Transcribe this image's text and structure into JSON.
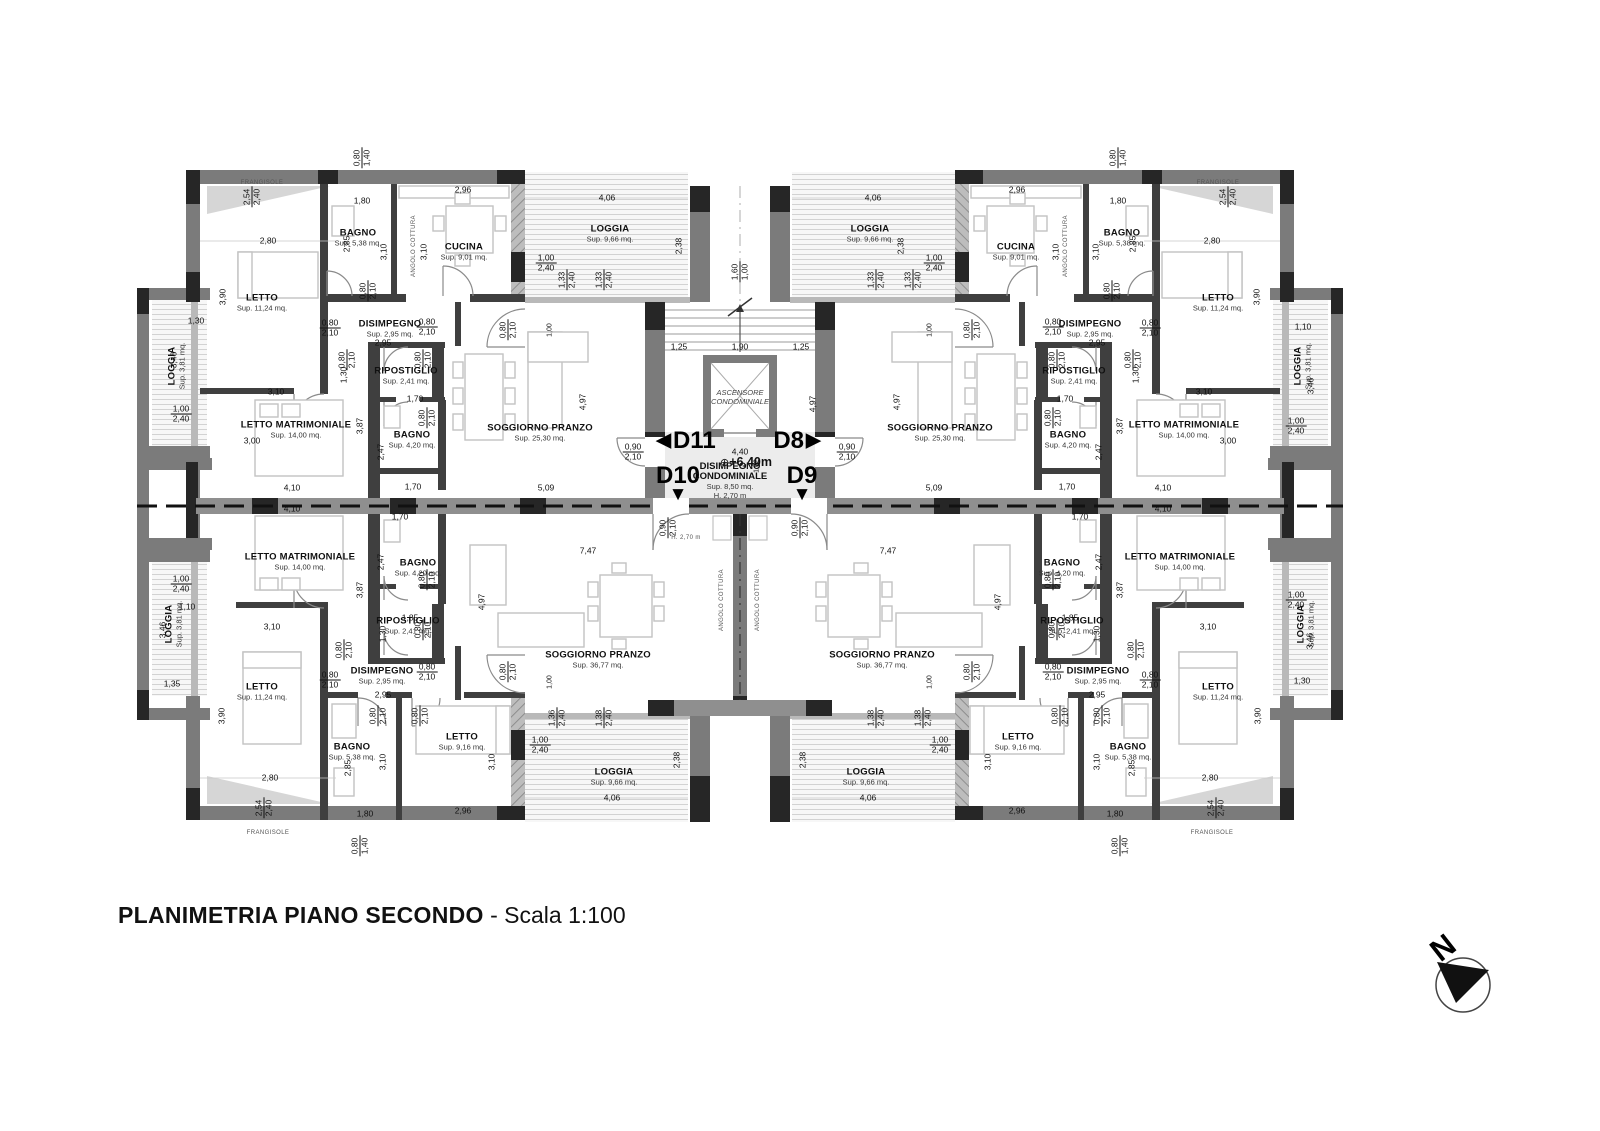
{
  "title": {
    "main": "PLANIMETRIA PIANO SECONDO",
    "scale": " - Scala 1:100"
  },
  "north": {
    "label": "N"
  },
  "core": {
    "elevator_line1": "ASCENSORE",
    "elevator_line2": "CONDOMINIALE",
    "landing_title1": "DISIMPEGNO",
    "landing_title2": "CONDOMINIALE",
    "landing_area": "Sup. 8,50 mq.",
    "landing_height": "H. 2,70 m",
    "level": "+6,40m",
    "level_symbol": "⊕"
  },
  "units": [
    {
      "id": "D11",
      "arrow": "left",
      "x": 686,
      "y": 441
    },
    {
      "id": "D8",
      "arrow": "right",
      "x": 797,
      "y": 441
    },
    {
      "id": "D10",
      "arrow": "down",
      "x": 678,
      "y": 484
    },
    {
      "id": "D9",
      "arrow": "down",
      "x": 802,
      "y": 484
    }
  ],
  "rooms": [
    {
      "n": "LETTO",
      "a": "Sup. 11,24 mq.",
      "x": 262,
      "y": 303
    },
    {
      "n": "BAGNO",
      "a": "Sup. 5,38 mq.",
      "x": 358,
      "y": 238
    },
    {
      "n": "CUCINA",
      "a": "Sup. 9,01 mq.",
      "x": 464,
      "y": 252
    },
    {
      "n": "DISIMPEGNO",
      "a": "Sup. 2,95 mq.",
      "x": 390,
      "y": 329
    },
    {
      "n": "RIPOSTIGLIO",
      "a": "Sup. 2,41 mq.",
      "x": 406,
      "y": 376
    },
    {
      "n": "BAGNO",
      "a": "Sup. 4,20 mq.",
      "x": 412,
      "y": 440
    },
    {
      "n": "LETTO MATRIMONIALE",
      "a": "Sup. 14,00 mq.",
      "x": 296,
      "y": 430
    },
    {
      "n": "SOGGIORNO PRANZO",
      "a": "Sup. 25,30 mq.",
      "x": 540,
      "y": 433
    },
    {
      "n": "LOGGIA",
      "a": "Sup. 9,66 mq.",
      "x": 610,
      "y": 234
    },
    {
      "n": "LOGGIA",
      "a": "Sup. 3,81 mq.",
      "x": 177,
      "y": 366,
      "r": -90
    },
    {
      "n": "LETTO",
      "a": "Sup. 11,24 mq.",
      "x": 1218,
      "y": 303
    },
    {
      "n": "BAGNO",
      "a": "Sup. 5,38 mq.",
      "x": 1122,
      "y": 238
    },
    {
      "n": "CUCINA",
      "a": "Sup. 9,01 mq.",
      "x": 1016,
      "y": 252
    },
    {
      "n": "DISIMPEGNO",
      "a": "Sup. 2,95 mq.",
      "x": 1090,
      "y": 329
    },
    {
      "n": "RIPOSTIGLIO",
      "a": "Sup. 2,41 mq.",
      "x": 1074,
      "y": 376
    },
    {
      "n": "BAGNO",
      "a": "Sup. 4,20 mq.",
      "x": 1068,
      "y": 440
    },
    {
      "n": "LETTO MATRIMONIALE",
      "a": "Sup. 14,00 mq.",
      "x": 1184,
      "y": 430
    },
    {
      "n": "SOGGIORNO PRANZO",
      "a": "Sup. 25,30 mq.",
      "x": 940,
      "y": 433
    },
    {
      "n": "LOGGIA",
      "a": "Sup. 9,66 mq.",
      "x": 870,
      "y": 234
    },
    {
      "n": "LOGGIA",
      "a": "Sup. 3,81 mq.",
      "x": 1303,
      "y": 366,
      "r": -90
    },
    {
      "n": "LETTO MATRIMONIALE",
      "a": "Sup. 14,00 mq.",
      "x": 300,
      "y": 562
    },
    {
      "n": "BAGNO",
      "a": "Sup. 4,20 mq.",
      "x": 418,
      "y": 568
    },
    {
      "n": "RIPOSTIGLIO",
      "a": "Sup. 2,41 mq.",
      "x": 408,
      "y": 626
    },
    {
      "n": "DISIMPEGNO",
      "a": "Sup. 2,95 mq.",
      "x": 382,
      "y": 676
    },
    {
      "n": "LETTO",
      "a": "Sup. 11,24 mq.",
      "x": 262,
      "y": 692
    },
    {
      "n": "BAGNO",
      "a": "Sup. 5,38 mq.",
      "x": 352,
      "y": 752
    },
    {
      "n": "LETTO",
      "a": "Sup. 9,16 mq.",
      "x": 462,
      "y": 742
    },
    {
      "n": "SOGGIORNO PRANZO",
      "a": "Sup. 36,77 mq.",
      "x": 598,
      "y": 660
    },
    {
      "n": "LOGGIA",
      "a": "Sup. 9,66 mq.",
      "x": 614,
      "y": 777
    },
    {
      "n": "LOGGIA",
      "a": "Sup. 3,81 mq.",
      "x": 174,
      "y": 624,
      "r": -90
    },
    {
      "n": "LETTO MATRIMONIALE",
      "a": "Sup. 14,00 mq.",
      "x": 1180,
      "y": 562
    },
    {
      "n": "BAGNO",
      "a": "Sup. 4,20 mq.",
      "x": 1062,
      "y": 568
    },
    {
      "n": "RIPOSTIGLIO",
      "a": "Sup. 2,41 mq.",
      "x": 1072,
      "y": 626
    },
    {
      "n": "DISIMPEGNO",
      "a": "Sup. 2,95 mq.",
      "x": 1098,
      "y": 676
    },
    {
      "n": "LETTO",
      "a": "Sup. 11,24 mq.",
      "x": 1218,
      "y": 692
    },
    {
      "n": "BAGNO",
      "a": "Sup. 5,38 mq.",
      "x": 1128,
      "y": 752
    },
    {
      "n": "LETTO",
      "a": "Sup. 9,16 mq.",
      "x": 1018,
      "y": 742
    },
    {
      "n": "SOGGIORNO PRANZO",
      "a": "Sup. 36,77 mq.",
      "x": 882,
      "y": 660
    },
    {
      "n": "LOGGIA",
      "a": "Sup. 9,66 mq.",
      "x": 866,
      "y": 777
    },
    {
      "n": "LOGGIA",
      "a": "Sup. 3,81 mq.",
      "x": 1306,
      "y": 624,
      "r": -90
    }
  ],
  "dims": [
    {
      "t": "0,80|1,40",
      "x": 362,
      "y": 158,
      "r": -90
    },
    {
      "t": "0,80|1,40",
      "x": 1118,
      "y": 158,
      "r": -90
    },
    {
      "t": "2,54|2,40",
      "x": 252,
      "y": 197,
      "r": -90
    },
    {
      "t": "2,54|2,40",
      "x": 1228,
      "y": 197,
      "r": -90
    },
    {
      "t": "1,80",
      "x": 362,
      "y": 201
    },
    {
      "t": "1,80",
      "x": 1118,
      "y": 201
    },
    {
      "t": "2,96",
      "x": 463,
      "y": 190
    },
    {
      "t": "2,96",
      "x": 1017,
      "y": 190
    },
    {
      "t": "4,06",
      "x": 607,
      "y": 198
    },
    {
      "t": "4,06",
      "x": 873,
      "y": 198
    },
    {
      "t": "2,80",
      "x": 268,
      "y": 241
    },
    {
      "t": "2,80",
      "x": 1212,
      "y": 241
    },
    {
      "t": "3,90",
      "x": 223,
      "y": 297,
      "r": -90
    },
    {
      "t": "3,90",
      "x": 1257,
      "y": 297,
      "r": -90
    },
    {
      "t": "3,10",
      "x": 384,
      "y": 252,
      "r": -90
    },
    {
      "t": "3,10",
      "x": 1096,
      "y": 252,
      "r": -90
    },
    {
      "t": "3,10",
      "x": 424,
      "y": 252,
      "r": -90
    },
    {
      "t": "3,10",
      "x": 1056,
      "y": 252,
      "r": -90
    },
    {
      "t": "2,85",
      "x": 347,
      "y": 244,
      "r": -90
    },
    {
      "t": "2,85",
      "x": 1133,
      "y": 244,
      "r": -90
    },
    {
      "t": "2,38",
      "x": 679,
      "y": 246,
      "r": -90
    },
    {
      "t": "2,38",
      "x": 901,
      "y": 246,
      "r": -90
    },
    {
      "t": "1,00|2,40",
      "x": 546,
      "y": 263
    },
    {
      "t": "1,00|2,40",
      "x": 934,
      "y": 263
    },
    {
      "t": "1,33|2,40",
      "x": 567,
      "y": 280,
      "r": -90
    },
    {
      "t": "1,33|2,40",
      "x": 604,
      "y": 280,
      "r": -90
    },
    {
      "t": "1,33|2,40",
      "x": 876,
      "y": 280,
      "r": -90
    },
    {
      "t": "1,33|2,40",
      "x": 913,
      "y": 280,
      "r": -90
    },
    {
      "t": "1,60|1,00",
      "x": 740,
      "y": 272,
      "r": -90
    },
    {
      "t": "1,25",
      "x": 679,
      "y": 347
    },
    {
      "t": "1,90",
      "x": 740,
      "y": 347
    },
    {
      "t": "1,25",
      "x": 801,
      "y": 347
    },
    {
      "t": "4,97",
      "x": 813,
      "y": 404,
      "r": -90
    },
    {
      "t": "4,97",
      "x": 583,
      "y": 402,
      "r": -90
    },
    {
      "t": "4,97",
      "x": 897,
      "y": 402,
      "r": -90
    },
    {
      "t": "4,40",
      "x": 740,
      "y": 452
    },
    {
      "t": "1,62",
      "x": 757,
      "y": 466,
      "r": -90,
      "s": 1
    },
    {
      "t": "0,90|2,10",
      "x": 633,
      "y": 452
    },
    {
      "t": "0,90|2,10",
      "x": 847,
      "y": 452
    },
    {
      "t": "0,90|2,10",
      "x": 668,
      "y": 528,
      "r": -90
    },
    {
      "t": "0,90|2,10",
      "x": 800,
      "y": 528,
      "r": -90
    },
    {
      "t": "5,09",
      "x": 546,
      "y": 488
    },
    {
      "t": "5,09",
      "x": 934,
      "y": 488
    },
    {
      "t": "4,10",
      "x": 292,
      "y": 488
    },
    {
      "t": "4,10",
      "x": 292,
      "y": 509
    },
    {
      "t": "4,10",
      "x": 1163,
      "y": 488
    },
    {
      "t": "4,10",
      "x": 1163,
      "y": 509
    },
    {
      "t": "7,47",
      "x": 588,
      "y": 551
    },
    {
      "t": "7,47",
      "x": 888,
      "y": 551
    },
    {
      "t": "2,95",
      "x": 383,
      "y": 343
    },
    {
      "t": "2,95",
      "x": 1097,
      "y": 343
    },
    {
      "t": "2,95",
      "x": 383,
      "y": 695
    },
    {
      "t": "2,95",
      "x": 1097,
      "y": 695
    },
    {
      "t": "1,00",
      "x": 550,
      "y": 330,
      "r": -90,
      "s": 1
    },
    {
      "t": "1,00",
      "x": 930,
      "y": 330,
      "r": -90,
      "s": 1
    },
    {
      "t": "1,00",
      "x": 550,
      "y": 682,
      "r": -90,
      "s": 1
    },
    {
      "t": "1,00",
      "x": 930,
      "y": 682,
      "r": -90,
      "s": 1
    },
    {
      "t": "3,00",
      "x": 252,
      "y": 441
    },
    {
      "t": "3,00",
      "x": 1228,
      "y": 441
    },
    {
      "t": "3,10",
      "x": 276,
      "y": 392
    },
    {
      "t": "3,10",
      "x": 1204,
      "y": 392
    },
    {
      "t": "3,10",
      "x": 272,
      "y": 627
    },
    {
      "t": "3,10",
      "x": 1208,
      "y": 627
    },
    {
      "t": "3,87",
      "x": 360,
      "y": 426,
      "r": -90
    },
    {
      "t": "3,87",
      "x": 1120,
      "y": 426,
      "r": -90
    },
    {
      "t": "3,87",
      "x": 360,
      "y": 590,
      "r": -90
    },
    {
      "t": "3,87",
      "x": 1120,
      "y": 590,
      "r": -90
    },
    {
      "t": "2,47",
      "x": 381,
      "y": 452,
      "r": -90
    },
    {
      "t": "2,47",
      "x": 1099,
      "y": 452,
      "r": -90
    },
    {
      "t": "2,47",
      "x": 381,
      "y": 562,
      "r": -90
    },
    {
      "t": "2,47",
      "x": 1099,
      "y": 562,
      "r": -90
    },
    {
      "t": "1,70",
      "x": 415,
      "y": 399
    },
    {
      "t": "1,70",
      "x": 1065,
      "y": 399
    },
    {
      "t": "1,70",
      "x": 413,
      "y": 487
    },
    {
      "t": "1,70",
      "x": 1067,
      "y": 487
    },
    {
      "t": "1,70",
      "x": 400,
      "y": 517
    },
    {
      "t": "1,70",
      "x": 1080,
      "y": 517
    },
    {
      "t": "1,85",
      "x": 410,
      "y": 618
    },
    {
      "t": "1,85",
      "x": 1070,
      "y": 618
    },
    {
      "t": "1,30",
      "x": 344,
      "y": 375,
      "r": -90
    },
    {
      "t": "1,30",
      "x": 1136,
      "y": 375,
      "r": -90
    },
    {
      "t": "1,30",
      "x": 383,
      "y": 634,
      "r": -90
    },
    {
      "t": "1,30",
      "x": 1097,
      "y": 634,
      "r": -90
    },
    {
      "t": "1,30",
      "x": 196,
      "y": 321
    },
    {
      "t": "1,10",
      "x": 1303,
      "y": 327
    },
    {
      "t": "3,46",
      "x": 174,
      "y": 360,
      "r": -90
    },
    {
      "t": "3,46",
      "x": 1311,
      "y": 386,
      "r": -90
    },
    {
      "t": "1,00|2,40",
      "x": 181,
      "y": 414
    },
    {
      "t": "1,00|2,40",
      "x": 1296,
      "y": 426
    },
    {
      "t": "1,00|2,40",
      "x": 181,
      "y": 584
    },
    {
      "t": "1,00|2,40",
      "x": 1296,
      "y": 600
    },
    {
      "t": "1,10",
      "x": 187,
      "y": 607
    },
    {
      "t": "3,46",
      "x": 163,
      "y": 630,
      "r": -90
    },
    {
      "t": "3,46",
      "x": 1310,
      "y": 641,
      "r": -90
    },
    {
      "t": "1,35",
      "x": 172,
      "y": 684
    },
    {
      "t": "1,30",
      "x": 1302,
      "y": 681
    },
    {
      "t": "3,90",
      "x": 222,
      "y": 716,
      "r": -90
    },
    {
      "t": "3,90",
      "x": 1258,
      "y": 716,
      "r": -90
    },
    {
      "t": "2,80",
      "x": 270,
      "y": 778
    },
    {
      "t": "2,80",
      "x": 1210,
      "y": 778
    },
    {
      "t": "1,80",
      "x": 365,
      "y": 814
    },
    {
      "t": "1,80",
      "x": 1115,
      "y": 814
    },
    {
      "t": "2,96",
      "x": 463,
      "y": 811
    },
    {
      "t": "2,96",
      "x": 1017,
      "y": 811
    },
    {
      "t": "2,85",
      "x": 348,
      "y": 768,
      "r": -90
    },
    {
      "t": "2,85",
      "x": 1132,
      "y": 768,
      "r": -90
    },
    {
      "t": "3,10",
      "x": 383,
      "y": 762,
      "r": -90
    },
    {
      "t": "3,10",
      "x": 1097,
      "y": 762,
      "r": -90
    },
    {
      "t": "3,10",
      "x": 492,
      "y": 762,
      "r": -90
    },
    {
      "t": "3,10",
      "x": 988,
      "y": 762,
      "r": -90
    },
    {
      "t": "2,54|2,40",
      "x": 264,
      "y": 808,
      "r": -90
    },
    {
      "t": "2,54|2,40",
      "x": 1216,
      "y": 808,
      "r": -90
    },
    {
      "t": "1,36|2,40",
      "x": 557,
      "y": 718,
      "r": -90
    },
    {
      "t": "1,38|2,40",
      "x": 604,
      "y": 718,
      "r": -90
    },
    {
      "t": "1,38|2,40",
      "x": 876,
      "y": 718,
      "r": -90
    },
    {
      "t": "1,38|2,40",
      "x": 923,
      "y": 718,
      "r": -90
    },
    {
      "t": "1,00|2,40",
      "x": 540,
      "y": 745
    },
    {
      "t": "1,00|2,40",
      "x": 940,
      "y": 745
    },
    {
      "t": "4,06",
      "x": 612,
      "y": 798
    },
    {
      "t": "4,06",
      "x": 868,
      "y": 798
    },
    {
      "t": "2,38",
      "x": 677,
      "y": 760,
      "r": -90
    },
    {
      "t": "2,38",
      "x": 803,
      "y": 760,
      "r": -90
    },
    {
      "t": "0,80|1,40",
      "x": 360,
      "y": 846,
      "r": -90
    },
    {
      "t": "0,80|1,40",
      "x": 1120,
      "y": 846,
      "r": -90
    },
    {
      "t": "4,97",
      "x": 482,
      "y": 602,
      "r": -90
    },
    {
      "t": "4,97",
      "x": 998,
      "y": 602,
      "r": -90
    },
    {
      "t": "0,80|2,10",
      "x": 330,
      "y": 328
    },
    {
      "t": "0,80|2,10",
      "x": 1150,
      "y": 328
    },
    {
      "t": "0,80|2,10",
      "x": 427,
      "y": 327
    },
    {
      "t": "0,80|2,10",
      "x": 1053,
      "y": 327
    },
    {
      "t": "0,80|2,10",
      "x": 508,
      "y": 330,
      "r": -90
    },
    {
      "t": "0,80|2,10",
      "x": 972,
      "y": 330,
      "r": -90
    },
    {
      "t": "0,80|2,10",
      "x": 368,
      "y": 291,
      "r": -90
    },
    {
      "t": "0,80|2,10",
      "x": 1112,
      "y": 291,
      "r": -90
    },
    {
      "t": "0,80|2,10",
      "x": 347,
      "y": 360,
      "r": -90
    },
    {
      "t": "0,80|2,10",
      "x": 1133,
      "y": 360,
      "r": -90
    },
    {
      "t": "0,80|2,10",
      "x": 423,
      "y": 360,
      "r": -90
    },
    {
      "t": "0,80|2,10",
      "x": 1057,
      "y": 360,
      "r": -90
    },
    {
      "t": "0,80|2,10",
      "x": 427,
      "y": 418,
      "r": -90
    },
    {
      "t": "0,80|2,10",
      "x": 1053,
      "y": 418,
      "r": -90
    },
    {
      "t": "0,80|2,10",
      "x": 330,
      "y": 680
    },
    {
      "t": "0,80|2,10",
      "x": 1150,
      "y": 680
    },
    {
      "t": "0,80|2,10",
      "x": 427,
      "y": 672
    },
    {
      "t": "0,80|2,10",
      "x": 1053,
      "y": 672
    },
    {
      "t": "0,80|2,10",
      "x": 508,
      "y": 672,
      "r": -90
    },
    {
      "t": "0,80|2,10",
      "x": 972,
      "y": 672,
      "r": -90
    },
    {
      "t": "0,80|2,10",
      "x": 344,
      "y": 650,
      "r": -90
    },
    {
      "t": "0,80|2,10",
      "x": 1136,
      "y": 650,
      "r": -90
    },
    {
      "t": "0,80|2,10",
      "x": 423,
      "y": 630,
      "r": -90
    },
    {
      "t": "0,80|2,10",
      "x": 1057,
      "y": 630,
      "r": -90
    },
    {
      "t": "0,80|2,10",
      "x": 427,
      "y": 580,
      "r": -90
    },
    {
      "t": "0,80|2,10",
      "x": 1053,
      "y": 580,
      "r": -90
    },
    {
      "t": "0,80|2,10",
      "x": 378,
      "y": 716,
      "r": -90
    },
    {
      "t": "0,80|2,10",
      "x": 1102,
      "y": 716,
      "r": -90
    },
    {
      "t": "0,80|2,10",
      "x": 420,
      "y": 716,
      "r": -90
    },
    {
      "t": "0,80|2,10",
      "x": 1060,
      "y": 716,
      "r": -90
    }
  ],
  "micro": [
    {
      "t": "FRANGISOLE",
      "x": 262,
      "y": 183
    },
    {
      "t": "FRANGISOLE",
      "x": 1218,
      "y": 183
    },
    {
      "t": "FRANGISOLE",
      "x": 268,
      "y": 833
    },
    {
      "t": "FRANGISOLE",
      "x": 1212,
      "y": 833
    },
    {
      "t": "ANGOLO COTTURA",
      "x": 414,
      "y": 246,
      "r": -90
    },
    {
      "t": "ANGOLO COTTURA",
      "x": 1066,
      "y": 246,
      "r": -90
    },
    {
      "t": "ANGOLO COTTURA",
      "x": 722,
      "y": 600,
      "r": -90
    },
    {
      "t": "ANGOLO COTTURA",
      "x": 758,
      "y": 600,
      "r": -90
    },
    {
      "t": "H. 2,70 m",
      "x": 686,
      "y": 538
    }
  ]
}
